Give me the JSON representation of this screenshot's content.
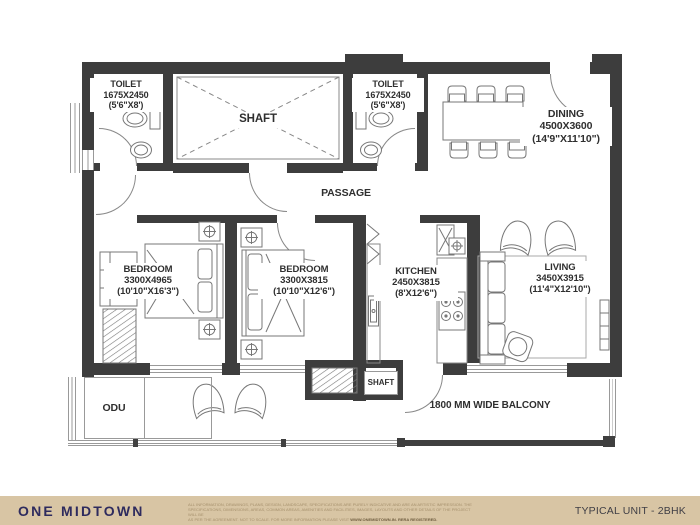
{
  "colors": {
    "wall": "#3d3d3d",
    "line": "#777777",
    "footer_bg": "#d8c5a4",
    "brand_navy": "#2e2b5e"
  },
  "plan": {
    "rooms": {
      "toilet1": {
        "name": "TOILET",
        "dim_mm": "1675X2450",
        "dim_ft": "(5'6\"X8')"
      },
      "toilet2": {
        "name": "TOILET",
        "dim_mm": "1675X2450",
        "dim_ft": "(5'6\"X8')"
      },
      "shaft_top": {
        "name": "SHAFT"
      },
      "dining": {
        "name": "DINING",
        "dim_mm": "4500X3600",
        "dim_ft": "(14'9\"X11'10\")"
      },
      "passage": {
        "name": "PASSAGE"
      },
      "bedroom1": {
        "name": "BEDROOM",
        "dim_mm": "3300X4965",
        "dim_ft": "(10'10\"X16'3\")"
      },
      "bedroom2": {
        "name": "BEDROOM",
        "dim_mm": "3300X3815",
        "dim_ft": "(10'10\"X12'6\")"
      },
      "kitchen": {
        "name": "KITCHEN",
        "dim_mm": "2450X3815",
        "dim_ft": "(8'X12'6\")"
      },
      "living": {
        "name": "LIVING",
        "dim_mm": "3450X3915",
        "dim_ft": "(11'4\"X12'10\")"
      },
      "odu": {
        "name": "ODU"
      },
      "shaft_bottom": {
        "name": "SHAFT"
      },
      "balcony": {
        "name": "1800 MM WIDE BALCONY"
      }
    }
  },
  "footer": {
    "brand": "ONE MIDTOWN",
    "unit_label": "TYPICAL UNIT - 2BHK",
    "disclaimer_line1": "ALL INFORMATION, DRAWINGS, PLANS, DESIGN, LANDSCAPE, SPECIFICATIONS ARE PURELY INDICATIVE AND ARE AN ARTISTIC IMPRESSION. THE",
    "disclaimer_line2": "SPECIFICATIONS, DIMENSIONS, AREAS, COMMON AREAS, AMENITIES AND FACILITIES, IMAGES, LAYOUTS AND OTHER DETAILS OF THE PROJECT WILL BE",
    "disclaimer_line3": "AS PER THE AGREEMENT. NOT TO SCALE. FOR MORE INFORMATION PLEASE VISIT",
    "disclaimer_bold": "WWW.ONEMIDTOWN.IN. RERA REGISTERED."
  }
}
